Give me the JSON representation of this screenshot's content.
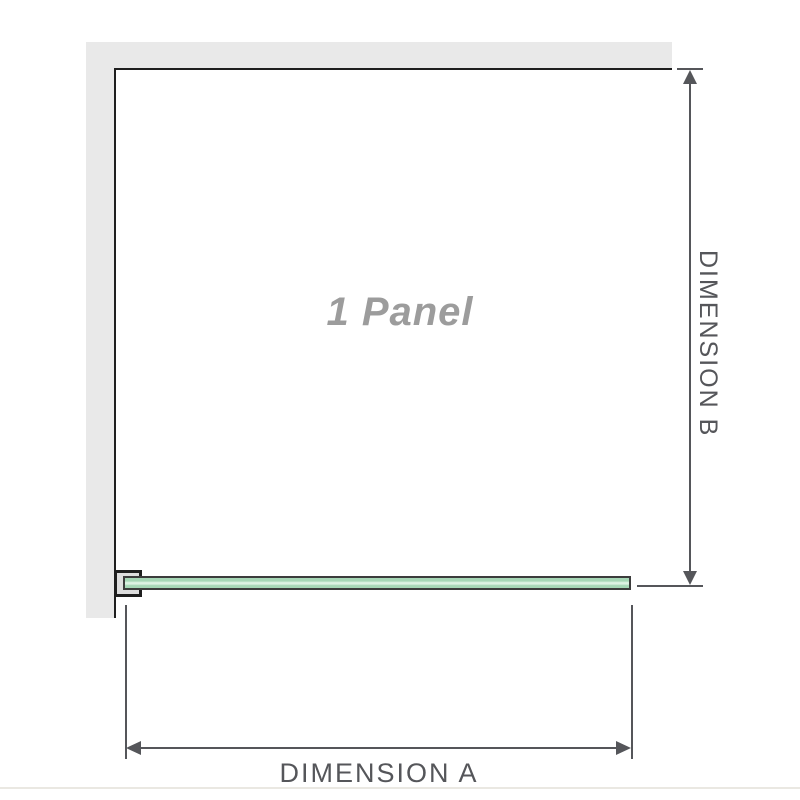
{
  "diagram": {
    "type": "shower-panel-dimension-diagram",
    "panel_label": "1 Panel",
    "dimension_a_label": "DIMENSION A",
    "dimension_b_label": "DIMENSION B"
  },
  "colors": {
    "wall_fill": "#e9e9e9",
    "wall_edge": "#1f1f1f",
    "glass_border": "#3c3c3c",
    "glass_fill": "#a6d7b6",
    "glass_highlight": "#ddf2e3",
    "bracket_fill": "#dedede",
    "dimension_line": "#55565a",
    "panel_text": "#9c9c9c",
    "background": "#ffffff",
    "baseline_rule": "#eae8e2"
  }
}
